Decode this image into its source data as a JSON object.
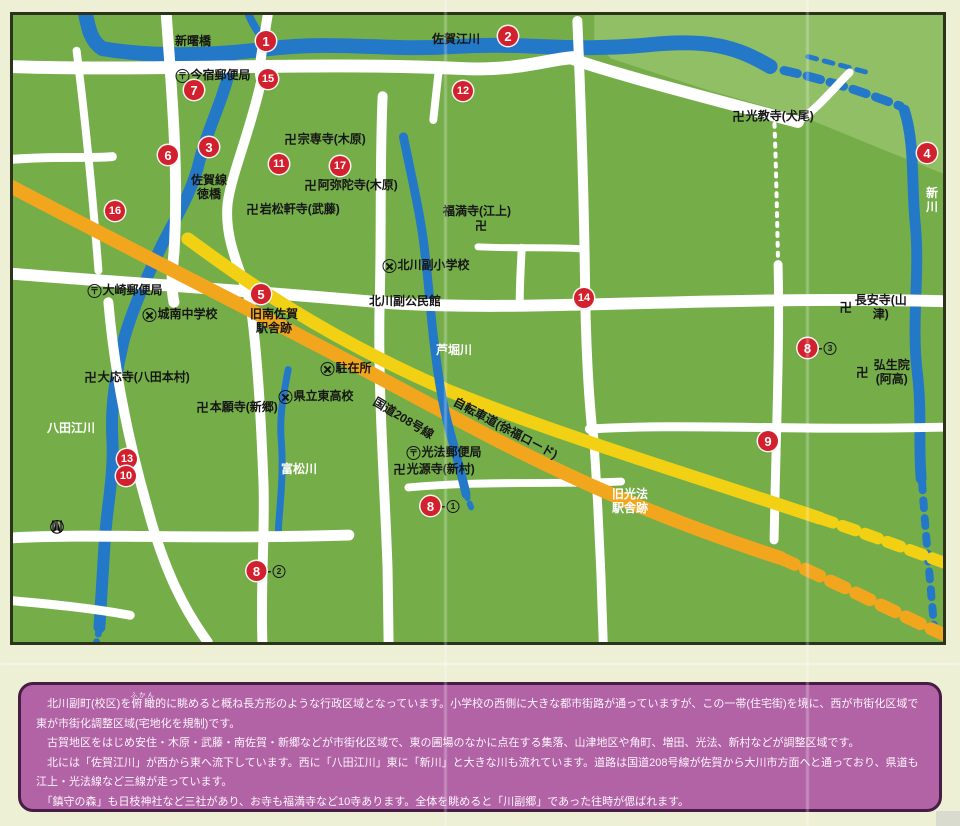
{
  "map": {
    "colors": {
      "page-bg": "#eef0d5",
      "map-green": "#75ae49",
      "light-green": "#97c26b",
      "river": "#2478c8",
      "road": "#ffffff",
      "route-orange": "#f2a61e",
      "cycle-yellow": "#f2d013",
      "marker-red": "#d2202e",
      "panel-bg": "#b163a6",
      "panel-border": "#461d44",
      "map-border": "#2c331d",
      "ink": "#161616"
    },
    "compass": {
      "north_label": "N"
    },
    "markers": [
      {
        "num": "1",
        "x": 253,
        "y": 26
      },
      {
        "num": "2",
        "x": 495,
        "y": 21
      },
      {
        "num": "15",
        "x": 255,
        "y": 64
      },
      {
        "num": "7",
        "x": 181,
        "y": 75
      },
      {
        "num": "12",
        "x": 450,
        "y": 76
      },
      {
        "num": "3",
        "x": 196,
        "y": 132
      },
      {
        "num": "6",
        "x": 155,
        "y": 140
      },
      {
        "num": "11",
        "x": 266,
        "y": 149
      },
      {
        "num": "17",
        "x": 327,
        "y": 151
      },
      {
        "num": "4",
        "x": 914,
        "y": 138
      },
      {
        "num": "16",
        "x": 102,
        "y": 196
      },
      {
        "num": "5",
        "x": 248,
        "y": 279
      },
      {
        "num": "14",
        "x": 571,
        "y": 283
      },
      {
        "num": "8",
        "suffix": "3",
        "x": 804,
        "y": 333
      },
      {
        "num": "9",
        "x": 755,
        "y": 426
      },
      {
        "num": "13",
        "x": 114,
        "y": 444
      },
      {
        "num": "10",
        "x": 113,
        "y": 461
      },
      {
        "num": "8",
        "suffix": "1",
        "x": 427,
        "y": 491
      },
      {
        "num": "8",
        "suffix": "2",
        "x": 253,
        "y": 556
      }
    ],
    "labels": [
      {
        "text": "新曙橋",
        "x": 180,
        "y": 27
      },
      {
        "text": "佐賀江川",
        "x": 443,
        "y": 25
      },
      {
        "text": "今宿郵便局",
        "sym": "post",
        "x": 200,
        "y": 61
      },
      {
        "text": "宗専寺(木原)",
        "sym": "temple",
        "x": 312,
        "y": 125
      },
      {
        "text": "光教寺(犬尾)",
        "sym": "temple",
        "x": 760,
        "y": 102
      },
      {
        "text": "佐賀線\n徳橋",
        "x": 196,
        "y": 173
      },
      {
        "text": "阿弥陀寺(木原)",
        "sym": "temple",
        "x": 338,
        "y": 171
      },
      {
        "text": "岩松軒寺(武藤)",
        "sym": "temple",
        "x": 280,
        "y": 195
      },
      {
        "text": "新川",
        "white": true,
        "x": 919,
        "y": 186
      },
      {
        "text": "福満寺(江上)",
        "x": 464,
        "y": 197
      },
      {
        "text": "卍",
        "x": 468,
        "y": 212
      },
      {
        "text": "北川副小学校",
        "sym": "school",
        "x": 413,
        "y": 251
      },
      {
        "text": "北川副公民館",
        "x": 392,
        "y": 287
      },
      {
        "text": "大崎郵便局",
        "sym": "post",
        "x": 112,
        "y": 276
      },
      {
        "text": "城南中学校",
        "sym": "school",
        "x": 167,
        "y": 300
      },
      {
        "text": "旧南佐賀\n駅舎跡",
        "x": 261,
        "y": 307
      },
      {
        "text": "芦堀川",
        "white": true,
        "x": 441,
        "y": 336
      },
      {
        "text": "長安寺(山津)",
        "sym": "temple",
        "x": 861,
        "y": 293
      },
      {
        "text": "駐在所",
        "sym": "school",
        "x": 333,
        "y": 354
      },
      {
        "text": "大応寺(八田本村)",
        "sym": "temple",
        "x": 124,
        "y": 363
      },
      {
        "text": "弘生院(阿高)",
        "sym": "temple",
        "x": 872,
        "y": 358
      },
      {
        "text": "県立東高校",
        "sym": "school",
        "x": 303,
        "y": 382
      },
      {
        "text": "本願寺(新郷)",
        "sym": "temple",
        "x": 224,
        "y": 393
      },
      {
        "text": "国道208号線",
        "x": 390,
        "y": 404,
        "rotate": 31
      },
      {
        "text": "自転車道(徐福ロード)",
        "x": 492,
        "y": 414,
        "rotate": 28
      },
      {
        "text": "光法郵便局",
        "sym": "post",
        "x": 431,
        "y": 438
      },
      {
        "text": "光源寺(新村)",
        "sym": "temple",
        "x": 421,
        "y": 455
      },
      {
        "text": "八田江川",
        "white": true,
        "x": 58,
        "y": 414
      },
      {
        "text": "富松川",
        "white": true,
        "x": 286,
        "y": 455
      },
      {
        "text": "旧光法\n駅舎跡",
        "white": true,
        "x": 617,
        "y": 487
      }
    ]
  },
  "panel": {
    "p1_before": "　北川副町(校区)を",
    "p1_ruby_base": "俯瞰",
    "p1_ruby": "ふかん",
    "p1_after": "的に眺めると概ね長方形のような行政区域となっています。小学校の西側に大きな都市街路が通っていますが、この一帯(住宅街)を境に、西が市街化区域で東が市街化調整区域(宅地化を規制)です。",
    "p2": "　古賀地区をはじめ安住・木原・武藤・南佐賀・新郷などが市街化区域で、東の圃場のなかに点在する集落、山津地区や角町、増田、光法、新村などが調整区域です。",
    "p3": "　北には「佐賀江川」が西から東へ流下しています。西に「八田江川」東に「新川」と大きな川も流れています。道路は国道208号線が佐賀から大川市方面へと通っており、県道も江上・光法線など三線が走っています。",
    "p4": "　「鎮守の森」も日枝神社など三社があり、お寺も福満寺など10寺あります。全体を眺めると「川副郷」であった往時が偲ばれます。"
  }
}
